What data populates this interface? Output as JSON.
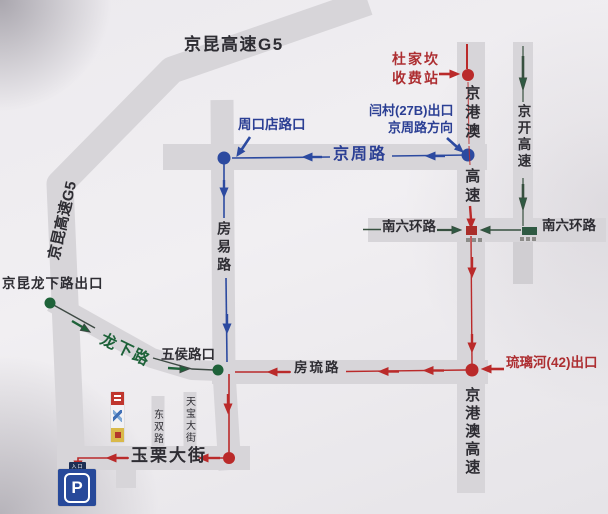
{
  "map": {
    "title_top": "京昆高速G5",
    "g5_left": "京昆高速G5",
    "roads": {
      "jingzhou": "京周路",
      "fangyi": "房易路",
      "longxia": "龙下路",
      "fangliu": "房琉路",
      "nanliuhuan_left": "南六环路",
      "nanliuhuan_right": "南六环路",
      "jinggangao": "京港澳",
      "gaosu": "高速",
      "jingkai": "京开高速",
      "jinggangao_gaosu": "京港澳高速",
      "dongshuang": "东双路",
      "tianbao": "天宝大街",
      "yuli": "玉栗大街"
    },
    "labels": {
      "dujiakan_1": "杜家坎",
      "dujiakan_2": "收费站",
      "yancun_1": "闫村(27B)出口",
      "yancun_2": "京周路方向",
      "zhoukoudian": "周口店路口",
      "jingkun_longxia_exit": "京昆龙下路出口",
      "wuhou": "五侯路口",
      "liulihe_exit": "琉璃河(42)出口",
      "parking_p": "P",
      "parking_entrance": "入口"
    },
    "colors": {
      "road_gray": "#d7d5d9",
      "route_blue": "#2c4aa0",
      "route_red": "#ba2a2a",
      "route_green": "#1e6239",
      "ring_green": "#2e5942",
      "text_black": "#2e2d33",
      "parking_blue": "#27499a"
    }
  }
}
